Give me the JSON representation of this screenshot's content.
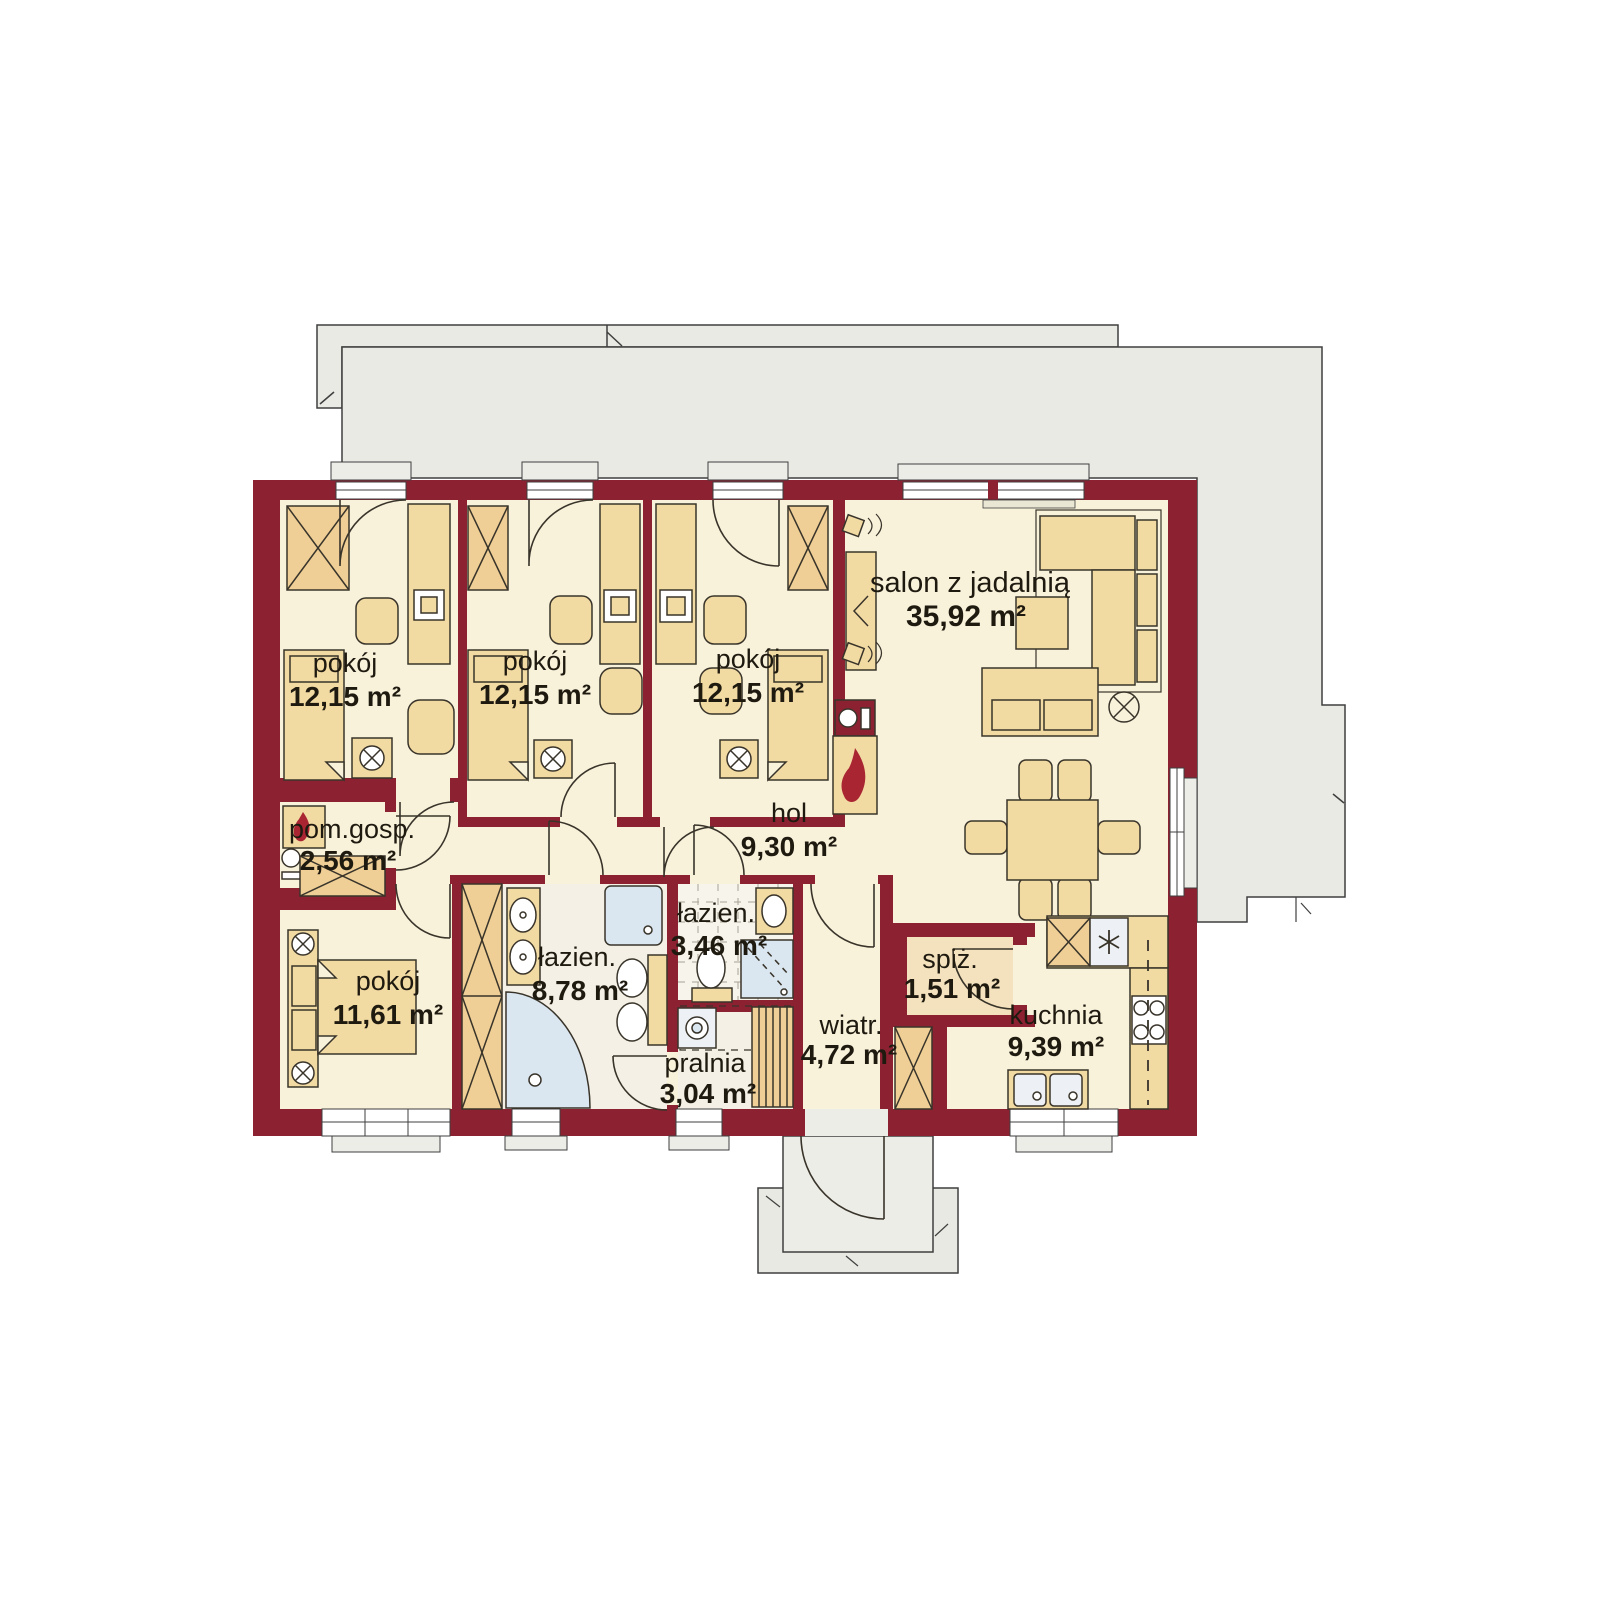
{
  "plan": {
    "type": "house-floor-plan",
    "rooms": [
      {
        "id": "bedroom-left",
        "name": "pokój",
        "area": "12,15 m²"
      },
      {
        "id": "bedroom-middle",
        "name": "pokój",
        "area": "12,15 m²"
      },
      {
        "id": "bedroom-right",
        "name": "pokój",
        "area": "12,15 m²"
      },
      {
        "id": "living-room",
        "name": "salon z jadalnią",
        "area": "35,92 m²"
      },
      {
        "id": "utility-room",
        "name": "pom.gosp.",
        "area": "2,56 m²"
      },
      {
        "id": "hall",
        "name": "hol",
        "area": "9,30 m²"
      },
      {
        "id": "bedroom-master",
        "name": "pokój",
        "area": "11,61 m²"
      },
      {
        "id": "bathroom-large",
        "name": "łazien.",
        "area": "8,78 m²"
      },
      {
        "id": "bathroom-small",
        "name": "łazien.",
        "area": "3,46 m²"
      },
      {
        "id": "laundry",
        "name": "pralnia",
        "area": "3,04 m²"
      },
      {
        "id": "vestibule",
        "name": "wiatr.",
        "area": "4,72 m²"
      },
      {
        "id": "pantry",
        "name": "spiż.",
        "area": "1,51 m²"
      },
      {
        "id": "kitchen",
        "name": "kuchnia",
        "area": "9,39 m²"
      }
    ],
    "colors": {
      "wall": "#8C2132",
      "floor": "#F8F2DB",
      "bath_floor": "#F4F0E5",
      "furniture": "#F2DAA3",
      "hatch": "#EFCF96",
      "fixture_blue": "#DAE6F0",
      "terrace": "#EAEAE5",
      "flame": "#A92532",
      "outline": "#39342A"
    }
  }
}
